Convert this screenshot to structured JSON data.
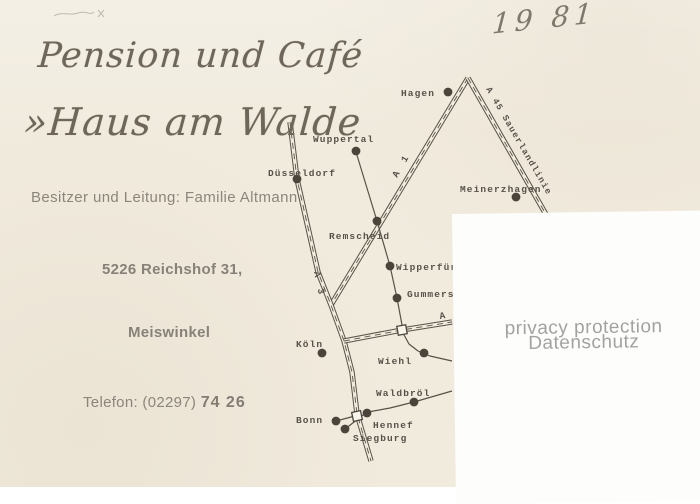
{
  "postcard": {
    "title_line1": "Pension und Café",
    "title_line2": "»Haus am Walde",
    "owner_line": "Besitzer und Leitung: Familie Altmann",
    "address_line": "5226 Reichshof 31,",
    "locality": "Meiswinkel",
    "phone_prefix": "Telefon: (02297) ",
    "phone_number": "74 26",
    "handwritten_year": "19 81"
  },
  "privacy": {
    "line1": "privacy protection",
    "line2": "Datenschutz"
  },
  "colors": {
    "card": "#f1ebde",
    "ink": "#575147",
    "dot": "#4a443b",
    "label": "#57514a",
    "text_gray": "#8b857b",
    "privacy_text": "#a3a2a0",
    "overlay_bg": "#fdfdfb"
  },
  "map": {
    "roads": [
      {
        "id": "a1",
        "type": "double",
        "points": [
          [
            468,
            78
          ],
          [
            331,
            305
          ]
        ]
      },
      {
        "id": "a45",
        "type": "double",
        "points": [
          [
            468,
            78
          ],
          [
            548,
            218
          ]
        ]
      },
      {
        "id": "a3",
        "type": "double",
        "points": [
          [
            290,
            122
          ],
          [
            297,
            179
          ],
          [
            318,
            272
          ],
          [
            331,
            305
          ],
          [
            344,
            341
          ],
          [
            352,
            372
          ],
          [
            357,
            414
          ],
          [
            371,
            461
          ]
        ]
      },
      {
        "id": "a4",
        "type": "double",
        "points": [
          [
            344,
            341
          ],
          [
            402,
            330
          ],
          [
            452,
            322
          ]
        ]
      },
      {
        "id": "b-road",
        "type": "single",
        "points": [
          [
            356,
            152
          ],
          [
            377,
            221
          ],
          [
            390,
            266
          ],
          [
            397,
            298
          ],
          [
            402,
            325
          ]
        ]
      },
      {
        "id": "wiehl-road",
        "type": "single",
        "points": [
          [
            403,
            333
          ],
          [
            409,
            344
          ],
          [
            418,
            351
          ],
          [
            430,
            356
          ],
          [
            452,
            361
          ]
        ]
      },
      {
        "id": "waldbroel-road",
        "type": "single",
        "points": [
          [
            360,
            417
          ],
          [
            368,
            412
          ],
          [
            390,
            408
          ],
          [
            414,
            402
          ],
          [
            452,
            391
          ]
        ]
      },
      {
        "id": "bonn-spur",
        "type": "single",
        "points": [
          [
            336,
            421
          ],
          [
            355,
            416
          ]
        ]
      },
      {
        "id": "siegburg-spur",
        "type": "single",
        "points": [
          [
            345,
            429
          ],
          [
            358,
            419
          ]
        ]
      }
    ],
    "junction_squares": [
      {
        "x": 402,
        "y": 330,
        "rotate": -10
      },
      {
        "x": 357,
        "y": 416,
        "rotate": -12
      }
    ],
    "cities": [
      {
        "label": "Hagen",
        "dot": [
          448,
          92
        ],
        "label_pos": [
          401,
          96
        ]
      },
      {
        "label": "Wuppertal",
        "dot": [
          356,
          151
        ],
        "label_pos": [
          313,
          142
        ]
      },
      {
        "label": "Düsseldorf",
        "dot": [
          297,
          179
        ],
        "label_pos": [
          268,
          176
        ]
      },
      {
        "label": "Remscheid",
        "dot": [
          377,
          221
        ],
        "label_pos": [
          329,
          239
        ]
      },
      {
        "label": "Meinerzhagen",
        "dot": [
          516,
          197
        ],
        "label_pos": [
          460,
          192
        ]
      },
      {
        "label": "Wipperfürth",
        "dot": [
          390,
          266
        ],
        "label_pos": [
          396,
          270
        ]
      },
      {
        "label": "Gummersbach",
        "dot": [
          397,
          298
        ],
        "label_pos": [
          407,
          297
        ]
      },
      {
        "label": "Köln",
        "dot": [
          322,
          353
        ],
        "label_pos": [
          296,
          347
        ]
      },
      {
        "label": "Wiehl",
        "dot": [
          424,
          353
        ],
        "label_pos": [
          378,
          364
        ]
      },
      {
        "label": "Waldbröl",
        "dot": [
          414,
          402
        ],
        "label_pos": [
          376,
          396
        ]
      },
      {
        "label": "Bonn",
        "dot": [
          336,
          421
        ],
        "label_pos": [
          296,
          423
        ]
      },
      {
        "label": "Hennef",
        "dot": [
          367,
          413
        ],
        "label_pos": [
          373,
          428
        ]
      },
      {
        "label": "Siegburg",
        "dot": [
          345,
          429
        ],
        "label_pos": [
          353,
          441
        ]
      }
    ],
    "road_labels": [
      {
        "text": "A 1",
        "x": 397,
        "y": 178,
        "rotate": -60,
        "spacing": 3,
        "size": 9.5
      },
      {
        "text": "A 3",
        "x": 314,
        "y": 272,
        "rotate": 78,
        "spacing": 3,
        "size": 9.5
      },
      {
        "text": "A 4",
        "x": 440,
        "y": 319,
        "rotate": -10,
        "spacing": 2,
        "size": 9.5
      },
      {
        "text": "A 45 Sauerlandlinie",
        "x": 486,
        "y": 89,
        "rotate": 60,
        "spacing": 1.2,
        "size": 8.8
      }
    ]
  }
}
